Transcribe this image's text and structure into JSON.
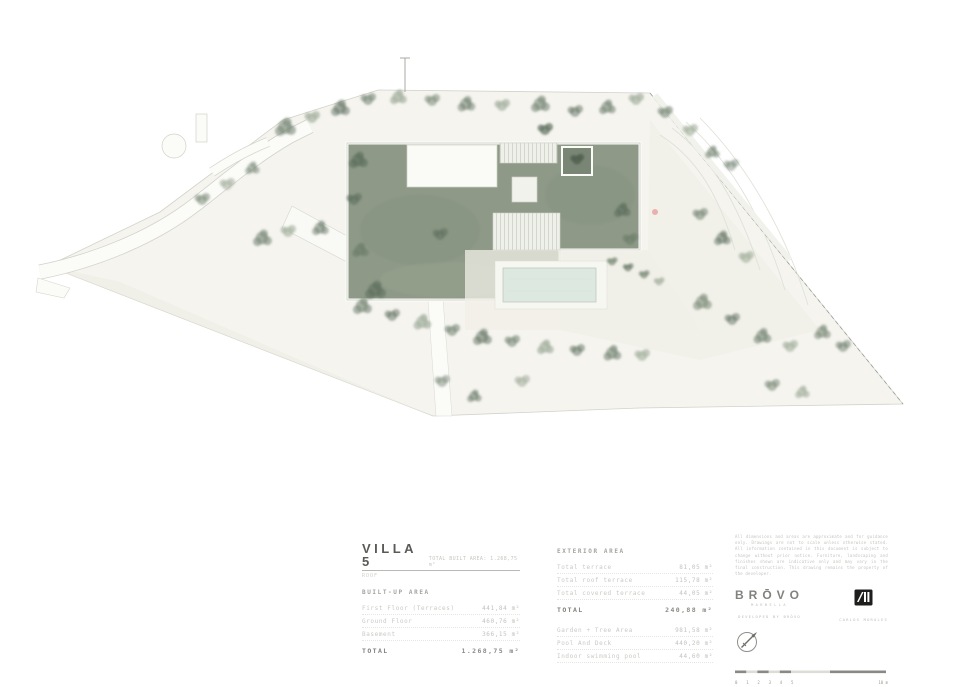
{
  "meta": {
    "drawing_title": "Villa 5 roof / site plan"
  },
  "colors": {
    "paper": "#ffffff",
    "parcel_fill": "#f5f4ef",
    "parcel_stroke": "#d2d2ca",
    "roof_garden": "#8e9a87",
    "tree_dark": "#5f705f",
    "tree_mid": "#7c8b79",
    "tree_light": "#a8b3a2",
    "pool": "#dde8e1",
    "accent_marker": "#e8a0a0",
    "title_text": "#5a5a57",
    "table_text": "#c9c9c4"
  },
  "villa": {
    "name": "VILLA 5",
    "subtitle": "ROOF",
    "header_note": "TOTAL BUILT AREA: 1.268,75 m²",
    "built_up": {
      "heading": "BUILT-UP AREA",
      "rows": [
        {
          "label": "First Floor (Terraces)",
          "value": "441,84 m²"
        },
        {
          "label": "Ground Floor",
          "value": "460,76 m²"
        },
        {
          "label": "Basement",
          "value": "366,15 m²"
        }
      ],
      "total_label": "TOTAL",
      "total_value": "1.268,75 m²"
    },
    "exterior": {
      "heading": "EXTERIOR AREA",
      "rows": [
        {
          "label": "Total terrace",
          "value": "81,05 m²"
        },
        {
          "label": "Total roof terrace",
          "value": "115,78 m²"
        },
        {
          "label": "Total covered terrace",
          "value": "44,05 m²"
        }
      ],
      "total_label": "TOTAL",
      "total_value": "240,88 m²",
      "extra_rows": [
        {
          "label": "Garden + Tree Area",
          "value": "981,58 m²"
        },
        {
          "label": "Pool And Deck",
          "value": "440,20 m²"
        },
        {
          "label": "Indoor swimming pool",
          "value": "44,60 m²"
        }
      ]
    }
  },
  "titleblock": {
    "notes": "All dimensions and areas are approximate and for guidance only. Drawings are not to scale unless otherwise stated. All information contained in this document is subject to change without prior notice. Furniture, landscaping and finishes shown are indicative only and may vary in the final construction. This drawing remains the property of the developer.",
    "brand": {
      "name": "BRŌVO",
      "sub": "MARBELLA",
      "caption": "DEVELOPED BY BRŌVO"
    },
    "architect": {
      "caption": "CARLOS MORALES"
    },
    "scalebar": {
      "ticks": [
        "0",
        "1",
        "2",
        "3",
        "4",
        "5"
      ],
      "end_label": "10 m"
    }
  }
}
